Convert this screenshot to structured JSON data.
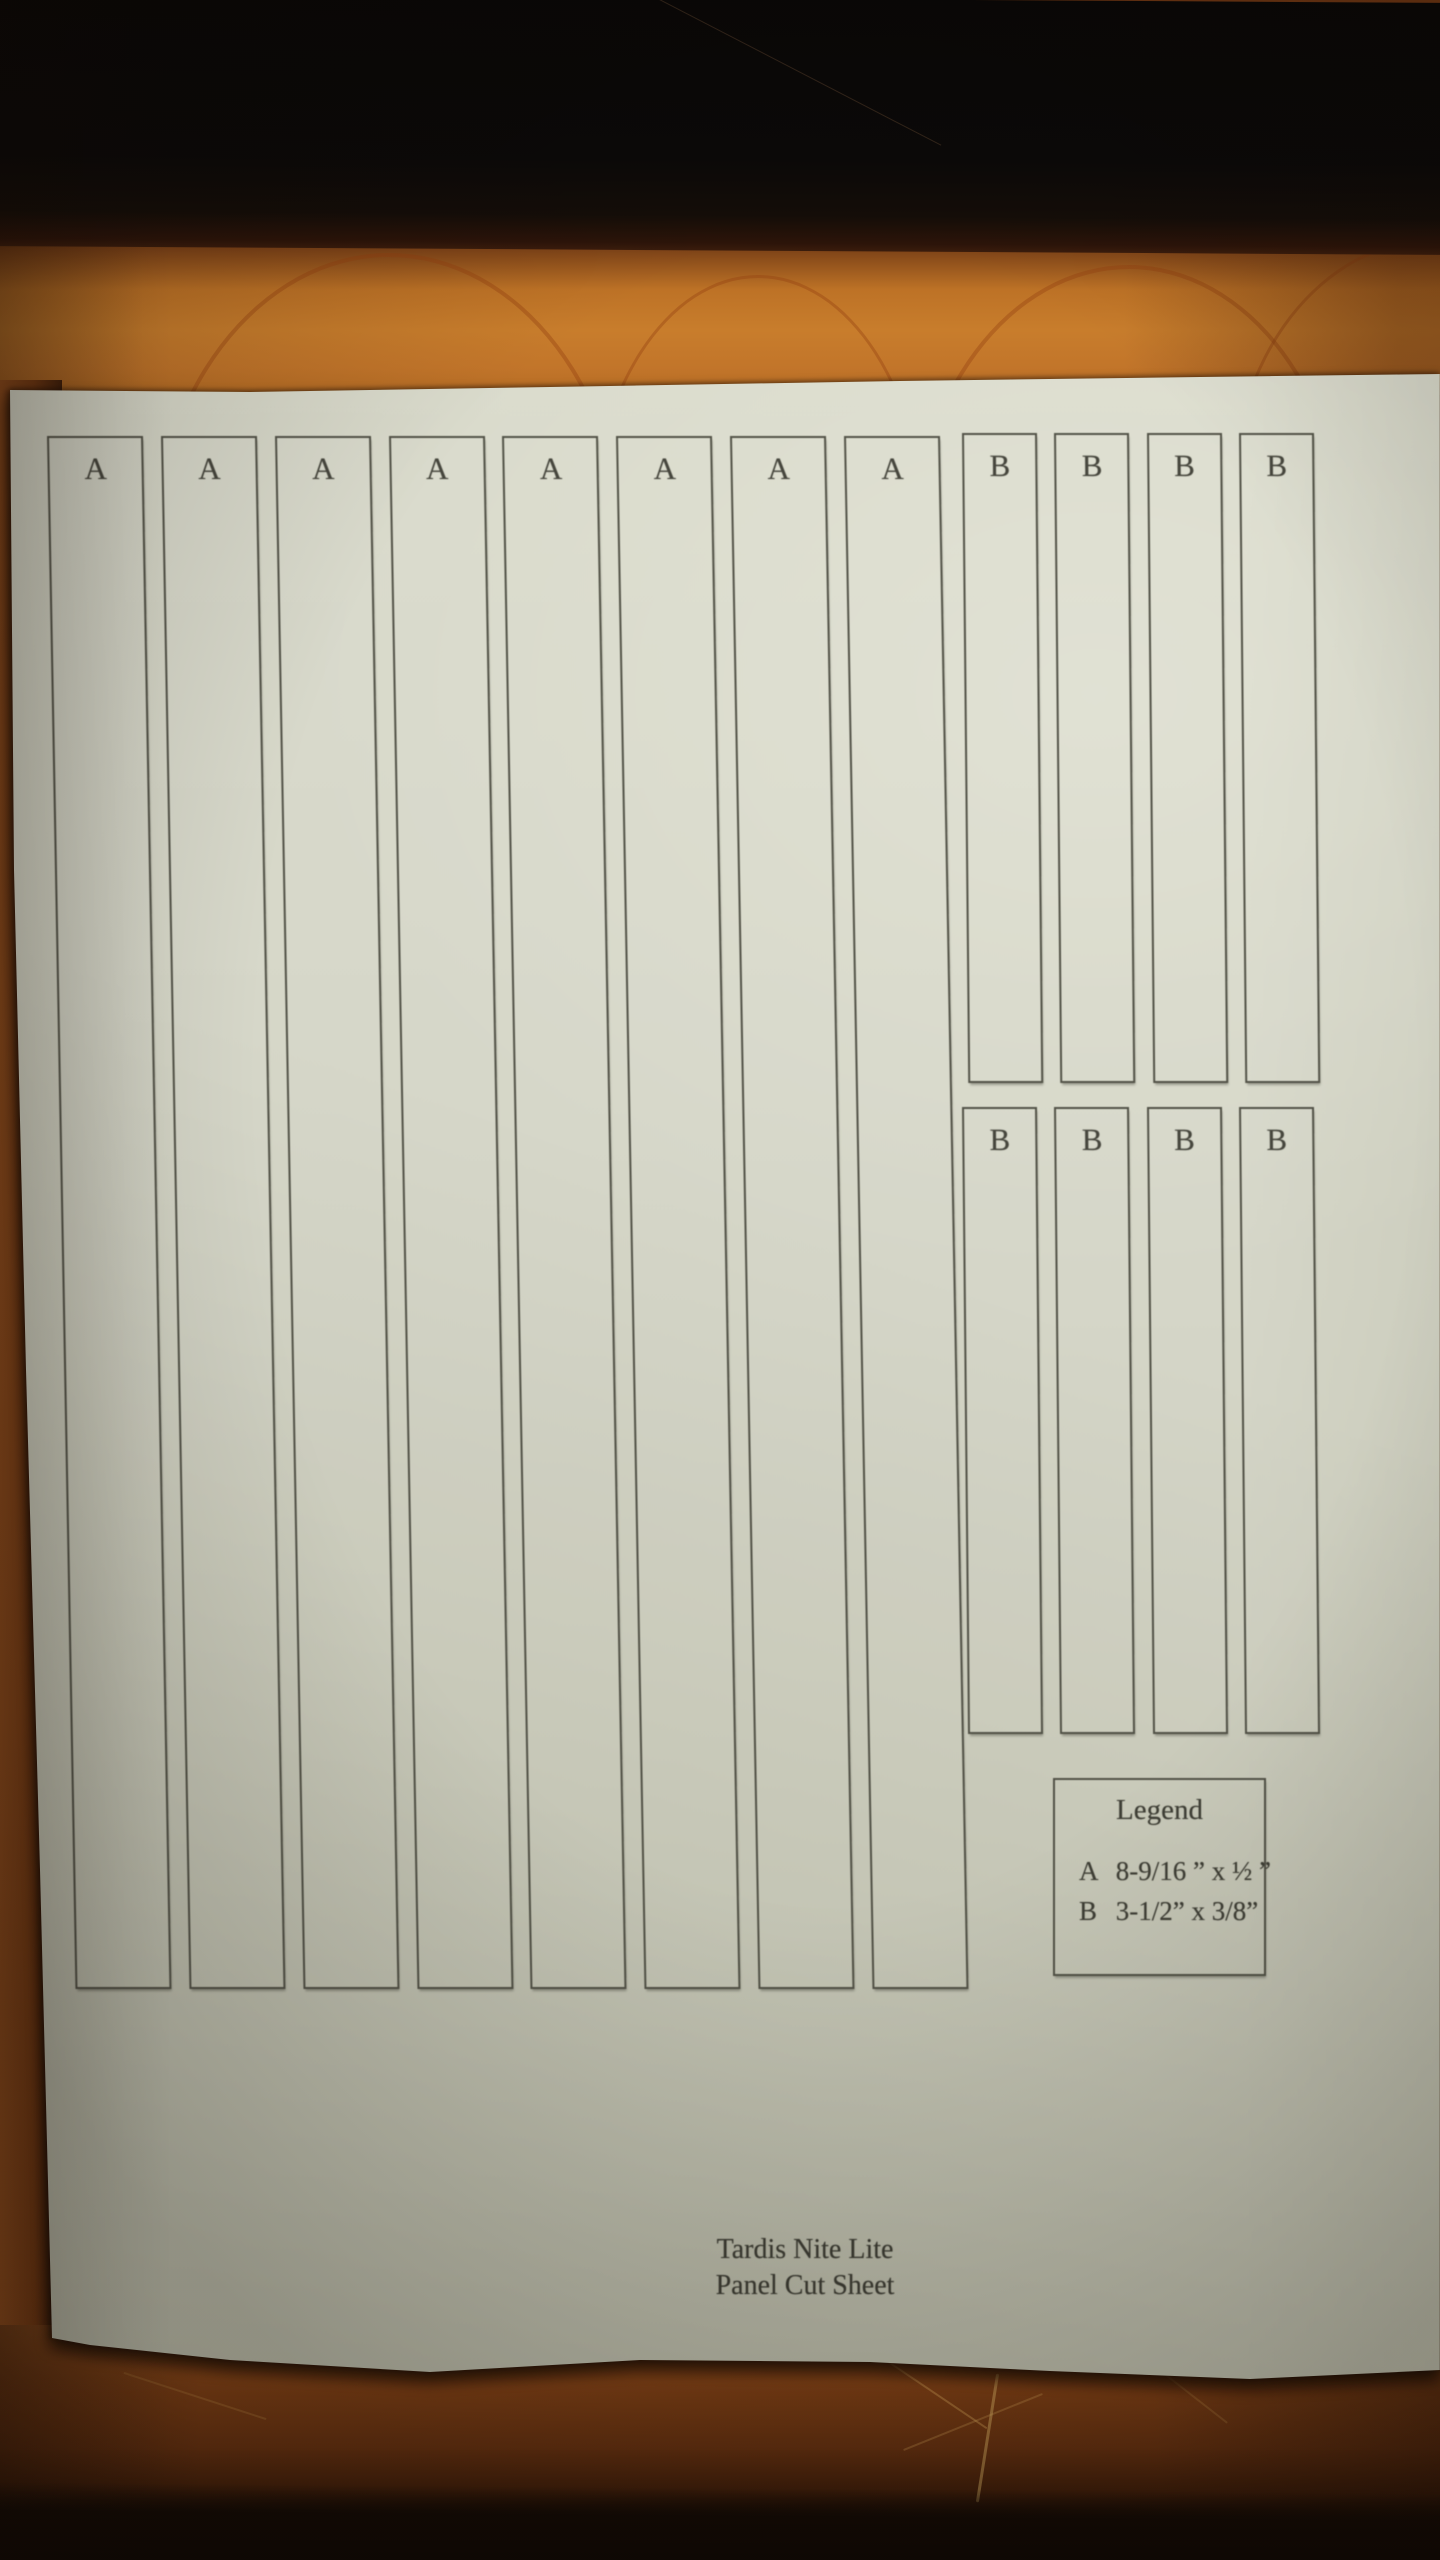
{
  "sheet": {
    "panel_rows": {
      "a_row": {
        "labels": [
          "A",
          "A",
          "A",
          "A",
          "A",
          "A",
          "A",
          "A"
        ]
      },
      "b_row_top": {
        "labels": [
          "B",
          "B",
          "B",
          "B"
        ]
      },
      "b_row_bottom": {
        "labels": [
          "B",
          "B",
          "B",
          "B"
        ]
      }
    },
    "legend": {
      "title": "Legend",
      "entries": [
        {
          "key": "A",
          "size": "8-9/16 ” x ½ ”"
        },
        {
          "key": "B",
          "size": "3-1/2” x 3/8”"
        }
      ]
    },
    "footer": {
      "line1": "Tardis Nite Lite",
      "line2": "Panel Cut Sheet"
    }
  },
  "colors": {
    "paper": "#d5d6c7",
    "print_line": "#48483d",
    "ink": "#3e3e35",
    "wood_light": "#c87d2c",
    "wood_dark": "#633010",
    "shadow_black": "#0b0908"
  }
}
